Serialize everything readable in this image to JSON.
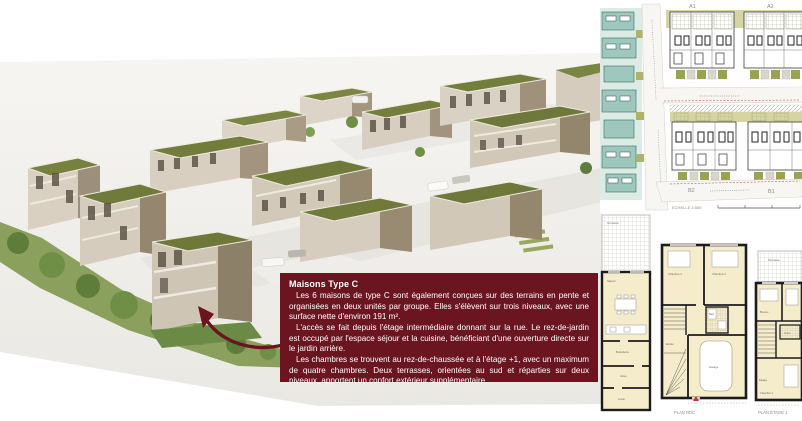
{
  "infobox": {
    "title": "Maisons Type C",
    "paragraphs": [
      "Les 6 maisons de type C sont également conçues sur des terrains en pente et organisées en deux unités par groupe. Elles s'élèvent sur trois niveaux, avec une surface nette d'environ 191 m².",
      "L'accès se fait depuis l'étage intermédiaire donnant sur la rue. Le rez-de-jardin est occupé par l'espace séjour et la cuisine, bénéficiant d'une ouverture directe sur le jardin arrière.",
      "Les chambres se trouvent au rez-de-chaussée et à l'étage +1, avec un maximum de quatre chambres. Deux terrasses, orientées au sud et réparties sur deux niveaux, apportent un confort extérieur supplémentaire."
    ],
    "bg_color": "#6a1520",
    "text_color": "#ffffff"
  },
  "site_plan": {
    "block_labels": {
      "a1": "A1",
      "a2": "A2",
      "b2": "B2",
      "b1": "B1"
    },
    "scale_label": "ECHELLE 1:500"
  },
  "floor_plans": {
    "captions": {
      "rdc": "PLAN RDC",
      "etage1": "PLAN ÉTAGE 1"
    },
    "rooms": {
      "terrasse": "Terrasse",
      "sejour": "Séjour",
      "buanderie": "Buanderie",
      "cave": "Cave",
      "local_technique": "Local",
      "chambre_3": "Chambre 3",
      "chambre_4": "Chambre 4",
      "bain": "Bain",
      "garage": "Garage",
      "entree": "Entrée",
      "bureau": "Bureau",
      "sdb": "S.d.b.",
      "chambre_1": "Chambre 1",
      "degagement": "Dégag."
    }
  },
  "colors": {
    "accent_maroon": "#6a1520",
    "roof_green": "#707b3b",
    "render_wall_light": "#d7cec0",
    "render_wall_shadow": "#998b72",
    "garden_green": "#8aa05c",
    "plan_room_fill": "#f4ecca",
    "site_garden_olive": "#d6d4a0",
    "site_teal_building": "#9ec7bd"
  }
}
